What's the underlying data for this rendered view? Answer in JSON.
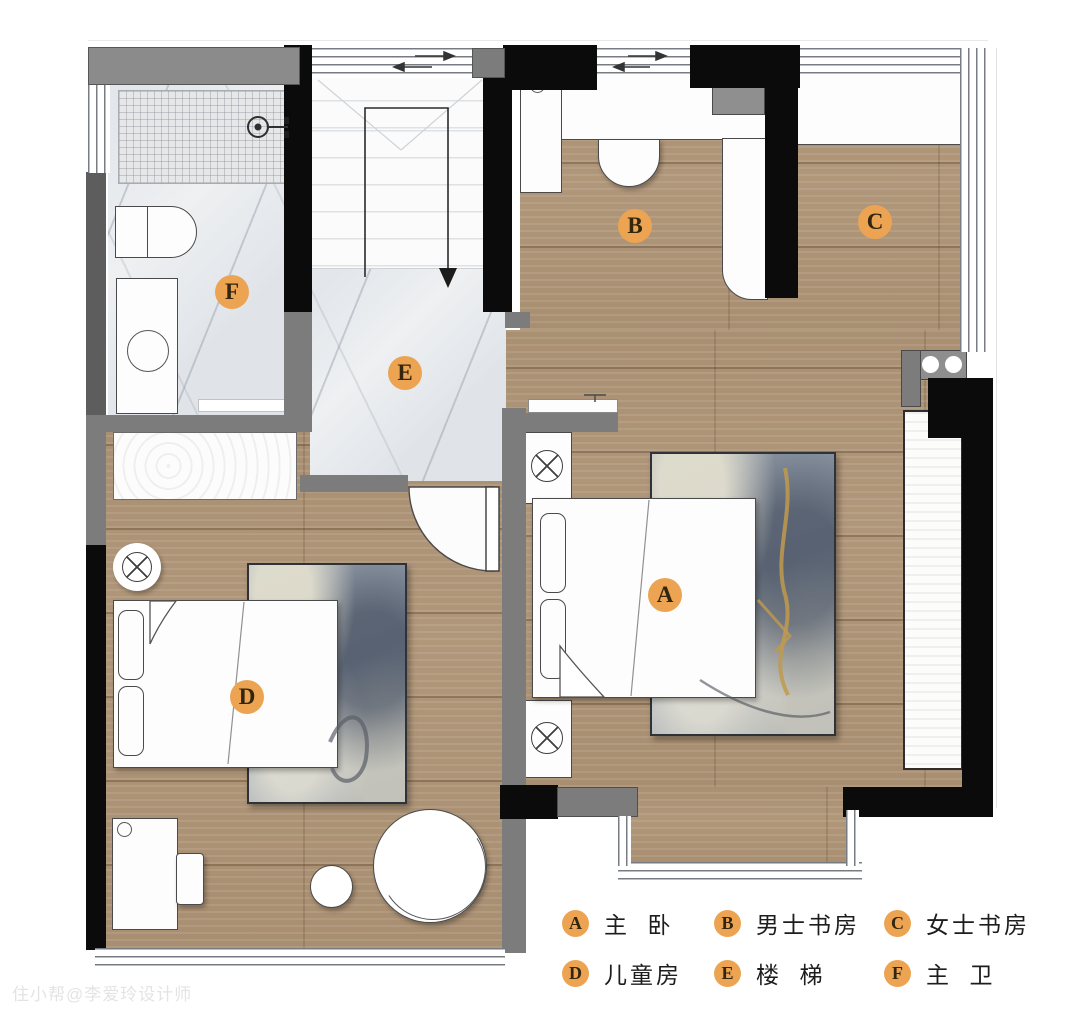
{
  "plan": {
    "title_hint": "second-floor residential floor plan",
    "watermark": "住小帮@李爱玲设计师"
  },
  "markers": [
    {
      "letter": "A",
      "room": "master-bedroom"
    },
    {
      "letter": "B",
      "room": "mens-study"
    },
    {
      "letter": "C",
      "room": "womens-study"
    },
    {
      "letter": "D",
      "room": "childrens-room"
    },
    {
      "letter": "E",
      "room": "stairs"
    },
    {
      "letter": "F",
      "room": "master-bathroom"
    }
  ],
  "legend": {
    "items": [
      {
        "key": "A",
        "label": "主  卧"
      },
      {
        "key": "B",
        "label": "男士书房"
      },
      {
        "key": "C",
        "label": "女士书房"
      },
      {
        "key": "D",
        "label": "儿童房"
      },
      {
        "key": "E",
        "label": "楼  梯"
      },
      {
        "key": "F",
        "label": "主  卫"
      }
    ]
  },
  "colors": {
    "badge_orange": "#ECA452",
    "wall_black": "#0B0B0B",
    "wall_gray": "#7C7C7C",
    "wood_floor": "#B1977A",
    "marble_floor": "#EEF0F2",
    "rug_blue_gray": "#8A93A0",
    "rug_gold_vein": "#C09A4E"
  }
}
